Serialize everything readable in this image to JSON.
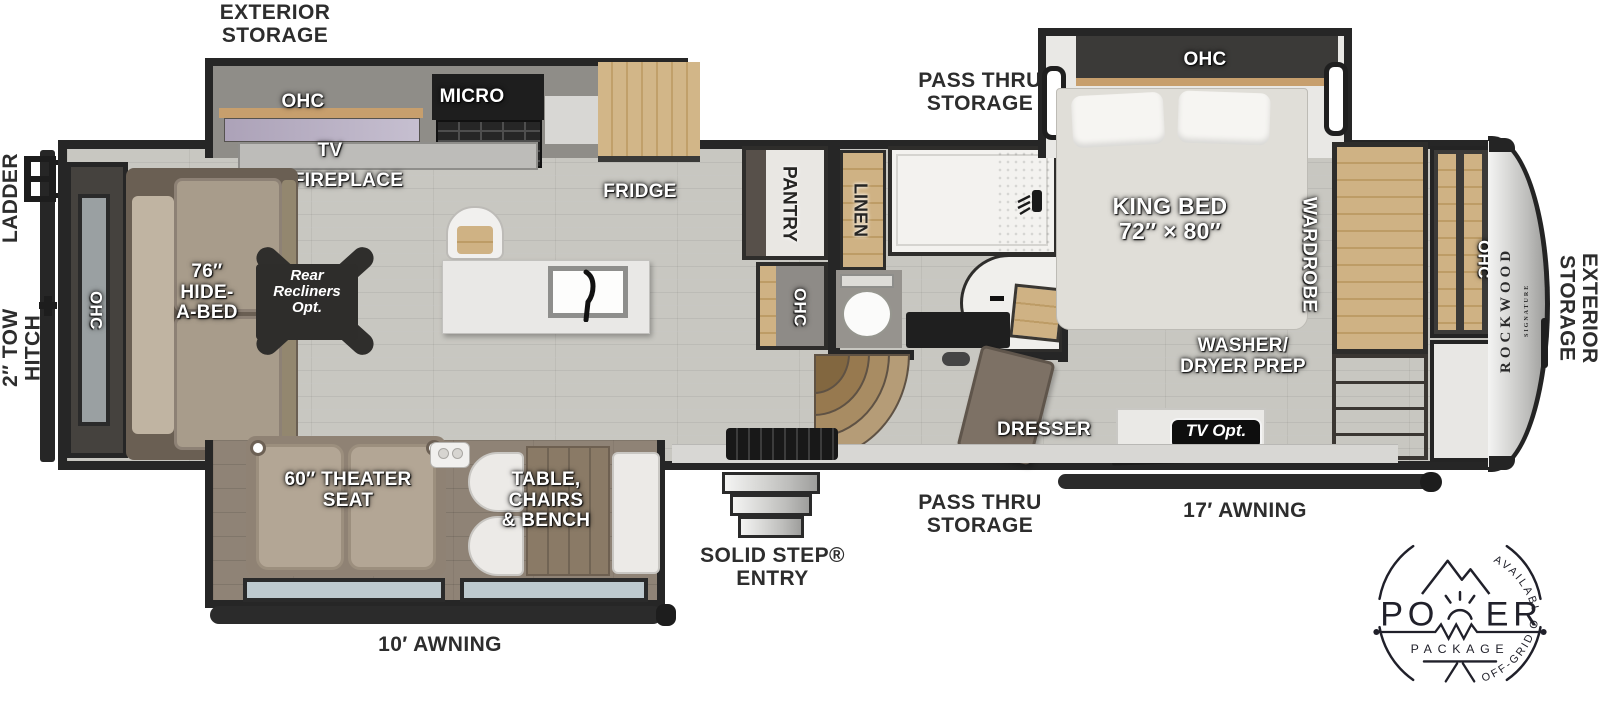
{
  "colors": {
    "wall": "#262626",
    "floor_wood": "#c8c7c1",
    "slide_floor": "#8f8376",
    "cabinet_wood": "#cdb183",
    "dark_cabinet": "#3b3a38",
    "counter": "#d8d7d4",
    "window_glass": "#bdc9ce",
    "sofa": "#a99d8c",
    "label_white": "#ffffff",
    "label_dark": "#2d2d2d",
    "badge_ink": "#20202a"
  },
  "outside": {
    "exterior_storage_top": "EXTERIOR\nSTORAGE",
    "ladder": "LADDER",
    "tow_hitch": "2″ TOW\nHITCH",
    "pass_thru_top": "PASS THRU\nSTORAGE",
    "pass_thru_bottom": "PASS THRU\nSTORAGE",
    "awning_17": "17′ AWNING",
    "awning_10": "10′ AWNING",
    "solid_step": "SOLID STEP®\nENTRY",
    "exterior_storage_front": "EXTERIOR\nSTORAGE"
  },
  "living": {
    "ohc_rear": "OHC",
    "hide_a_bed": "76″\nHIDE-\nA-BED",
    "recliners_opt": "Rear\nRecliners\nOpt.",
    "tv": "TV",
    "fireplace": "FIREPLACE"
  },
  "kitchen": {
    "ohc": "OHC",
    "micro": "MICRO",
    "fridge": "FRIDGE",
    "pantry": "PANTRY",
    "pantry_ohc": "OHC"
  },
  "bath": {
    "linen": "LINEN"
  },
  "bedroom": {
    "ohc": "OHC",
    "king_bed": "KING BED\n72″ × 80″",
    "wardrobe": "WARDROBE",
    "washer_dryer": "WASHER/\nDRYER PREP",
    "dresser": "DRESSER",
    "tv_opt": "TV Opt."
  },
  "front_cap": {
    "ohc": "OHC",
    "brand": "ROCKWOOD",
    "brand_sub": "SIGNATURE"
  },
  "rear_slide": {
    "theater_seat": "60″ THEATER\nSEAT",
    "table_group": "TABLE,\nCHAIRS\n& BENCH"
  },
  "badge": {
    "top": "AVAILABLE WITH",
    "power_left": "PO",
    "power_right": "ER",
    "package": "PACKAGE",
    "bottom": "OFF-GRID OPTIONS"
  }
}
